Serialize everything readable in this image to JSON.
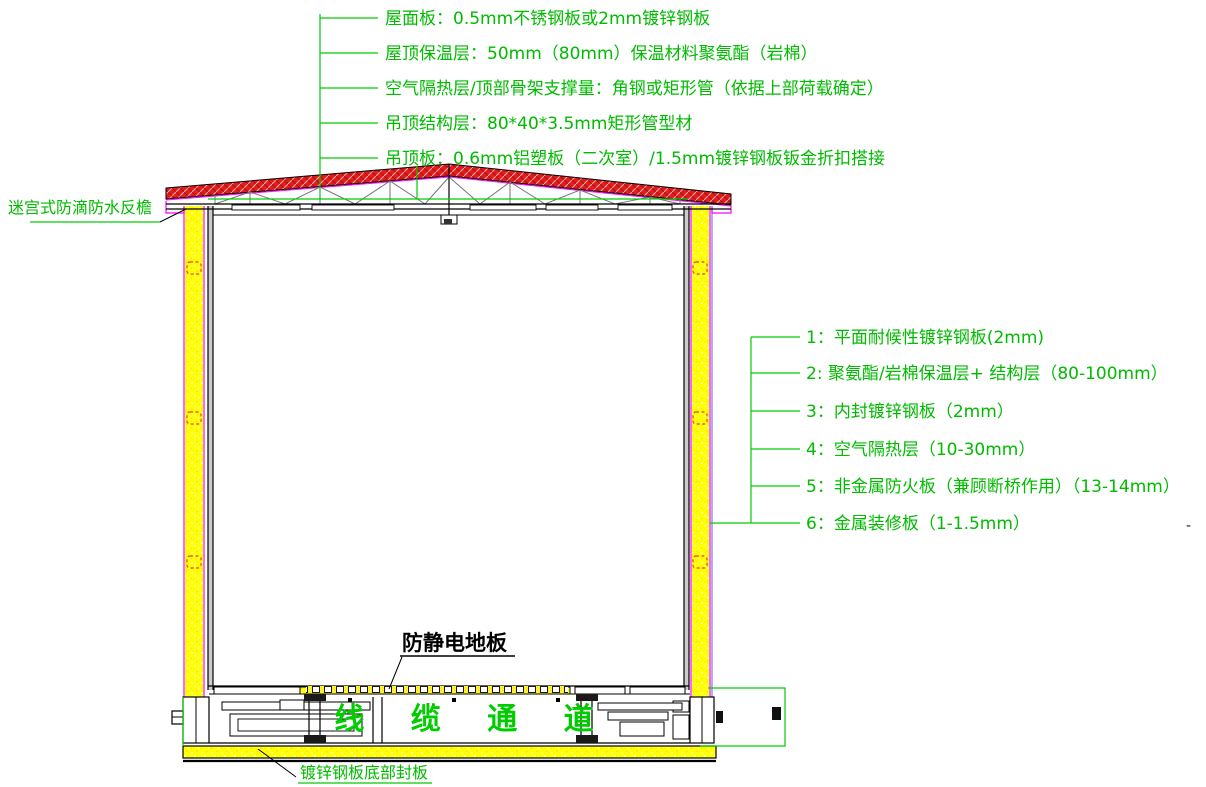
{
  "drawing_type": "building-section-detail",
  "colors": {
    "annotation_green": "#00bb00",
    "leader_green": "#00cc00",
    "roof_hatch_red": "#e31b1b",
    "panel_yellow": "#ffff00",
    "outline_magenta": "#ff00ff",
    "marker_orange": "#ff5500",
    "truss_gray": "#757575"
  },
  "roof_annotations": [
    "屋面板：0.5mm不锈钢板或2mm镀锌钢板",
    "屋顶保温层：50mm（80mm）保温材料聚氨酯（岩棉）",
    "空气隔热层/顶部骨架支撑量：角钢或矩形管（依据上部荷载确定）",
    "吊顶结构层：80*40*3.5mm矩形管型材",
    "吊顶板：0.6mm铝塑板（二次室）/1.5mm镀锌钢板钣金折扣搭接"
  ],
  "wall_annotations": [
    "1：平面耐候性镀锌钢板(2mm)",
    "2: 聚氨酯/岩棉保温层+ 结构层（80-100mm）",
    "3：内封镀锌钢板（2mm）",
    "4：空气隔热层（10-30mm）",
    "5：非金属防火板（兼顾断桥作用）（13-14mm）",
    "6：金属装修板（1-1.5mm）"
  ],
  "labels": {
    "left_eave": "迷宫式防滴防水反檐",
    "antistatic_floor": "防静电地板",
    "cable_channel": "线 缆 通 道",
    "bottom_plate": "镀锌钢板底部封板",
    "stray_dash": "-"
  }
}
